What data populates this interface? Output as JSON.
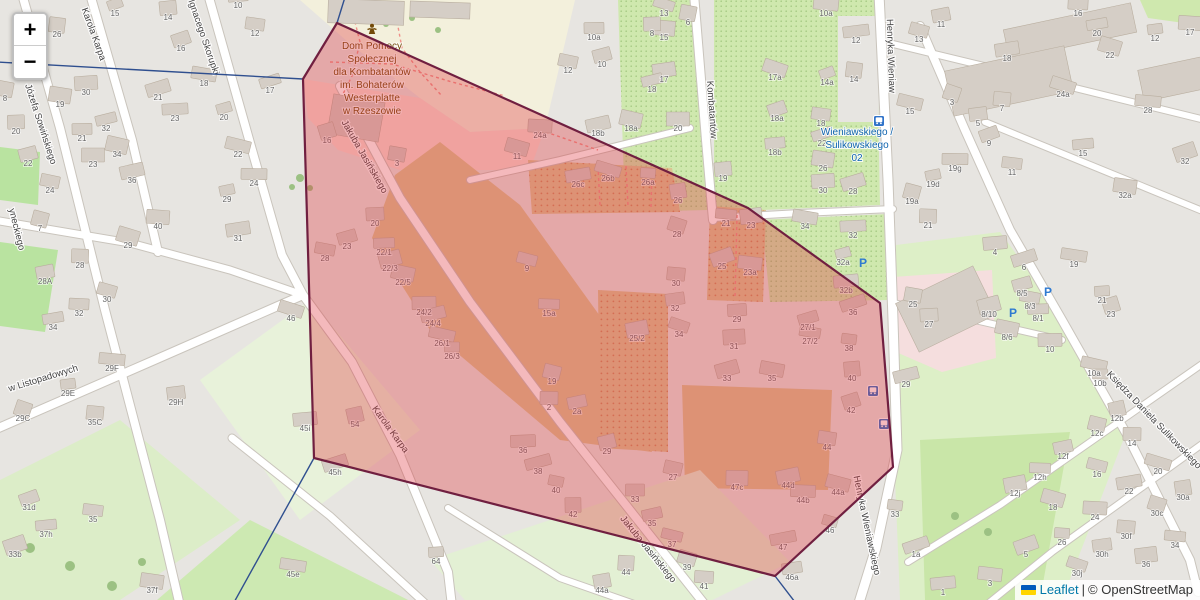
{
  "map": {
    "controls": {
      "zoom_in": "+",
      "zoom_out": "−"
    },
    "attribution": {
      "leaflet": "Leaflet",
      "separator": "|",
      "copyright": "© OpenStreetMap"
    },
    "colors": {
      "zone_fill": "#e0313a",
      "zone_border": "#701f40",
      "boundary_line": "#2f4f8f",
      "transit_blue": "#0e63ae",
      "poi_brown": "#734a08",
      "parking_blue": "#2f7ad1"
    },
    "poi_label": {
      "lines": [
        "Dom Pomocy",
        "Społecznej",
        "dla Kombatantów",
        "im. Bohaterów",
        "Westerplatte",
        "w Rzeszowie"
      ],
      "x": 372,
      "y": 49,
      "lh": 13
    },
    "transit_label": {
      "lines": [
        "Wieniawskiego /",
        "Sulikowskiego",
        "02"
      ],
      "x": 857,
      "y": 135,
      "lh": 13
    },
    "street_labels": [
      [
        "Karola Karpa",
        91,
        35,
        70
      ],
      [
        "Ignacego Skorupki",
        201,
        38,
        71
      ],
      [
        "Józefa Sowińskiego",
        38,
        125,
        72
      ],
      [
        "yneckiego",
        14,
        230,
        76
      ],
      [
        "w Listopadowych",
        44,
        381,
        -17
      ],
      [
        "Jakuba Jasińskiego",
        362,
        158,
        60
      ],
      [
        "Karola Karpa",
        388,
        431,
        54
      ],
      [
        "Jakuba Jasińskiego",
        646,
        551,
        51
      ],
      [
        "Kombatantów",
        709,
        110,
        86
      ],
      [
        "Henryka Wieniaw",
        888,
        56,
        88
      ],
      [
        "Henryka Wieniawskiego",
        864,
        526,
        78
      ],
      [
        "Księdza Daniela Sulikowskiego",
        1152,
        422,
        46
      ]
    ],
    "house_numbers": [
      [
        "15",
        115,
        13
      ],
      [
        "26",
        57,
        34
      ],
      [
        "14",
        168,
        17
      ],
      [
        "16",
        181,
        48
      ],
      [
        "12",
        255,
        33
      ],
      [
        "10",
        238,
        5
      ],
      [
        "17",
        270,
        90
      ],
      [
        "19",
        60,
        104
      ],
      [
        "30",
        86,
        92
      ],
      [
        "21",
        158,
        97
      ],
      [
        "18",
        204,
        83
      ],
      [
        "23",
        175,
        118
      ],
      [
        "20",
        224,
        117
      ],
      [
        "8",
        5,
        98
      ],
      [
        "20",
        16,
        131
      ],
      [
        "22",
        28,
        163
      ],
      [
        "24",
        50,
        190
      ],
      [
        "21",
        82,
        138
      ],
      [
        "32",
        106,
        128
      ],
      [
        "34",
        117,
        154
      ],
      [
        "23",
        93,
        164
      ],
      [
        "36",
        132,
        180
      ],
      [
        "22",
        238,
        154
      ],
      [
        "24",
        254,
        183
      ],
      [
        "29",
        227,
        199
      ],
      [
        "7",
        40,
        228
      ],
      [
        "28",
        80,
        265
      ],
      [
        "28A",
        45,
        281
      ],
      [
        "30",
        107,
        299
      ],
      [
        "32",
        79,
        313
      ],
      [
        "34",
        53,
        327
      ],
      [
        "29",
        128,
        245
      ],
      [
        "40",
        158,
        226
      ],
      [
        "31",
        238,
        238
      ],
      [
        "46",
        291,
        318
      ],
      [
        "29F",
        112,
        368
      ],
      [
        "29E",
        68,
        393
      ],
      [
        "29C",
        23,
        418
      ],
      [
        "35C",
        95,
        422
      ],
      [
        "29H",
        176,
        402
      ],
      [
        "31d",
        29,
        507
      ],
      [
        "35",
        93,
        519
      ],
      [
        "37h",
        46,
        534
      ],
      [
        "33b",
        15,
        554
      ],
      [
        "37f",
        152,
        590
      ],
      [
        "45i",
        305,
        428
      ],
      [
        "45h",
        335,
        472
      ],
      [
        "45e",
        293,
        574
      ],
      [
        "64",
        436,
        561
      ],
      [
        "16",
        327,
        140
      ],
      [
        "3",
        397,
        163
      ],
      [
        "20",
        375,
        223
      ],
      [
        "23",
        347,
        246
      ],
      [
        "28",
        325,
        258
      ],
      [
        "22/1",
        384,
        252
      ],
      [
        "22/3",
        390,
        268
      ],
      [
        "22/5",
        403,
        282
      ],
      [
        "24/2",
        424,
        312
      ],
      [
        "24/4",
        433,
        323
      ],
      [
        "26/1",
        442,
        343
      ],
      [
        "26/3",
        452,
        356
      ],
      [
        "54",
        355,
        424
      ],
      [
        "19",
        552,
        381
      ],
      [
        "2",
        549,
        407
      ],
      [
        "2a",
        577,
        411
      ],
      [
        "9",
        527,
        268
      ],
      [
        "15a",
        549,
        313
      ],
      [
        "25/2",
        637,
        338
      ],
      [
        "11",
        517,
        156
      ],
      [
        "24a",
        540,
        135
      ],
      [
        "26c",
        578,
        184
      ],
      [
        "26b",
        608,
        178
      ],
      [
        "26a",
        648,
        182
      ],
      [
        "26",
        678,
        200
      ],
      [
        "28",
        677,
        234
      ],
      [
        "30",
        676,
        283
      ],
      [
        "32",
        675,
        308
      ],
      [
        "34",
        679,
        334
      ],
      [
        "21",
        726,
        223
      ],
      [
        "23",
        751,
        225
      ],
      [
        "25",
        722,
        266
      ],
      [
        "23a",
        750,
        272
      ],
      [
        "32b",
        846,
        290
      ],
      [
        "36",
        853,
        312
      ],
      [
        "38",
        849,
        348
      ],
      [
        "40",
        852,
        378
      ],
      [
        "42",
        851,
        410
      ],
      [
        "44",
        827,
        447
      ],
      [
        "29",
        737,
        319
      ],
      [
        "27/1",
        808,
        327
      ],
      [
        "27/2",
        810,
        341
      ],
      [
        "31",
        734,
        346
      ],
      [
        "33",
        727,
        378
      ],
      [
        "35",
        772,
        378
      ],
      [
        "36",
        523,
        450
      ],
      [
        "38",
        538,
        471
      ],
      [
        "40",
        556,
        490
      ],
      [
        "42",
        573,
        514
      ],
      [
        "29",
        607,
        451
      ],
      [
        "27",
        673,
        477
      ],
      [
        "33",
        635,
        499
      ],
      [
        "35",
        652,
        523
      ],
      [
        "37",
        672,
        544
      ],
      [
        "47c",
        737,
        487
      ],
      [
        "44d",
        788,
        485
      ],
      [
        "44a",
        838,
        492
      ],
      [
        "44b",
        803,
        500
      ],
      [
        "47",
        783,
        547
      ],
      [
        "46",
        830,
        530
      ],
      [
        "44",
        626,
        572
      ],
      [
        "44a",
        602,
        590
      ],
      [
        "39",
        687,
        567
      ],
      [
        "41",
        704,
        586
      ],
      [
        "46a",
        792,
        577
      ],
      [
        "13",
        664,
        13
      ],
      [
        "15",
        664,
        37
      ],
      [
        "17",
        664,
        79
      ],
      [
        "17a",
        775,
        77
      ],
      [
        "10a",
        826,
        13
      ],
      [
        "12",
        856,
        40
      ],
      [
        "14a",
        827,
        82
      ],
      [
        "14",
        854,
        79
      ],
      [
        "19",
        723,
        178
      ],
      [
        "18a",
        777,
        118
      ],
      [
        "18",
        821,
        123
      ],
      [
        "18b",
        775,
        152
      ],
      [
        "22",
        822,
        143
      ],
      [
        "26",
        823,
        168
      ],
      [
        "30",
        823,
        190
      ],
      [
        "28",
        853,
        191
      ],
      [
        "34",
        805,
        226
      ],
      [
        "32",
        853,
        235
      ],
      [
        "32a",
        843,
        262
      ],
      [
        "6",
        688,
        22
      ],
      [
        "8",
        652,
        33
      ],
      [
        "10",
        602,
        64
      ],
      [
        "12",
        568,
        70
      ],
      [
        "10a",
        594,
        37
      ],
      [
        "18",
        652,
        89
      ],
      [
        "18a",
        631,
        128
      ],
      [
        "20",
        678,
        128
      ],
      [
        "18b",
        598,
        133
      ],
      [
        "15",
        910,
        111
      ],
      [
        "19g",
        955,
        168
      ],
      [
        "19d",
        933,
        184
      ],
      [
        "19a",
        912,
        201
      ],
      [
        "21",
        928,
        225
      ],
      [
        "11",
        941,
        24
      ],
      [
        "13",
        919,
        39
      ],
      [
        "16",
        1078,
        13
      ],
      [
        "20",
        1097,
        33
      ],
      [
        "22",
        1110,
        55
      ],
      [
        "17",
        1190,
        32
      ],
      [
        "18",
        1007,
        58
      ],
      [
        "24a",
        1063,
        94
      ],
      [
        "28",
        1148,
        110
      ],
      [
        "12",
        1155,
        38
      ],
      [
        "3",
        952,
        102
      ],
      [
        "7",
        1002,
        108
      ],
      [
        "5",
        978,
        123
      ],
      [
        "9",
        989,
        143
      ],
      [
        "11",
        1012,
        172
      ],
      [
        "15",
        1083,
        153
      ],
      [
        "32",
        1185,
        161
      ],
      [
        "32a",
        1125,
        195
      ],
      [
        "4",
        995,
        252
      ],
      [
        "6",
        1024,
        267
      ],
      [
        "19",
        1074,
        264
      ],
      [
        "21",
        1102,
        300
      ],
      [
        "23",
        1111,
        314
      ],
      [
        "25",
        913,
        304
      ],
      [
        "27",
        929,
        324
      ],
      [
        "8/5",
        1022,
        293
      ],
      [
        "8/3",
        1030,
        306
      ],
      [
        "8/1",
        1038,
        318
      ],
      [
        "8/10",
        989,
        314
      ],
      [
        "8/6",
        1007,
        337
      ],
      [
        "10",
        1050,
        349
      ],
      [
        "29",
        906,
        384
      ],
      [
        "10a",
        1094,
        373
      ],
      [
        "10b",
        1100,
        383
      ],
      [
        "12b",
        1117,
        418
      ],
      [
        "12c",
        1097,
        433
      ],
      [
        "14",
        1132,
        443
      ],
      [
        "12f",
        1063,
        456
      ],
      [
        "16",
        1097,
        474
      ],
      [
        "12h",
        1040,
        477
      ],
      [
        "12j",
        1015,
        493
      ],
      [
        "18",
        1053,
        507
      ],
      [
        "24",
        1095,
        517
      ],
      [
        "22",
        1129,
        491
      ],
      [
        "20",
        1158,
        471
      ],
      [
        "26",
        1062,
        542
      ],
      [
        "30a",
        1183,
        497
      ],
      [
        "30c",
        1157,
        513
      ],
      [
        "30f",
        1126,
        536
      ],
      [
        "30h",
        1102,
        554
      ],
      [
        "30j",
        1077,
        573
      ],
      [
        "34",
        1175,
        545
      ],
      [
        "36",
        1146,
        564
      ],
      [
        "5",
        1026,
        554
      ],
      [
        "3",
        990,
        583
      ],
      [
        "1",
        943,
        592
      ],
      [
        "1a",
        916,
        554
      ],
      [
        "33",
        895,
        514
      ]
    ],
    "bus_icons": [
      [
        879,
        121
      ],
      [
        873,
        391
      ],
      [
        884,
        424
      ]
    ],
    "parking_icons": [
      [
        863,
        263
      ],
      [
        1048,
        292
      ],
      [
        1013,
        313
      ]
    ]
  }
}
